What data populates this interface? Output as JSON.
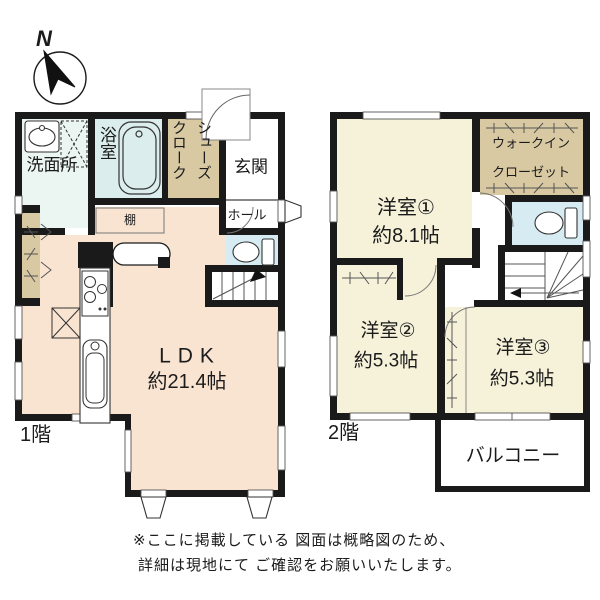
{
  "compass": {
    "north_label": "N"
  },
  "floor1": {
    "label": "1階",
    "rooms": {
      "washroom": "洗面所",
      "bathroom": "浴室",
      "shoes_closet_right": "シューズ",
      "shoes_closet_left": "クローク",
      "entrance": "玄関",
      "hall": "ホール",
      "shelf": "棚",
      "ldk_name": "LDK",
      "ldk_size": "約21.4帖"
    }
  },
  "floor2": {
    "label": "2階",
    "rooms": {
      "room1_name": "洋室①",
      "room1_size": "約8.1帖",
      "wic_line1": "ウォークイン",
      "wic_line2": "クローゼット",
      "room2_name": "洋室②",
      "room2_size": "約5.3帖",
      "room3_name": "洋室③",
      "room3_size": "約5.3帖",
      "balcony": "バルコニー"
    }
  },
  "disclaimer": {
    "line1": "※ここに掲載している 図面は概略図のため、",
    "line2": "詳細は現地にて ご確認をお願いいたします。"
  },
  "colors": {
    "wall": "#1a1a1a",
    "ldk_floor": "#f9e4d2",
    "western_room_floor": "#f6f2da",
    "closet_floor": "#d8c9a3",
    "bathroom_floor": "#dcedee",
    "washroom_floor": "#ebf5f2",
    "toilet_floor": "#d7ecf2",
    "background": "#ffffff"
  }
}
